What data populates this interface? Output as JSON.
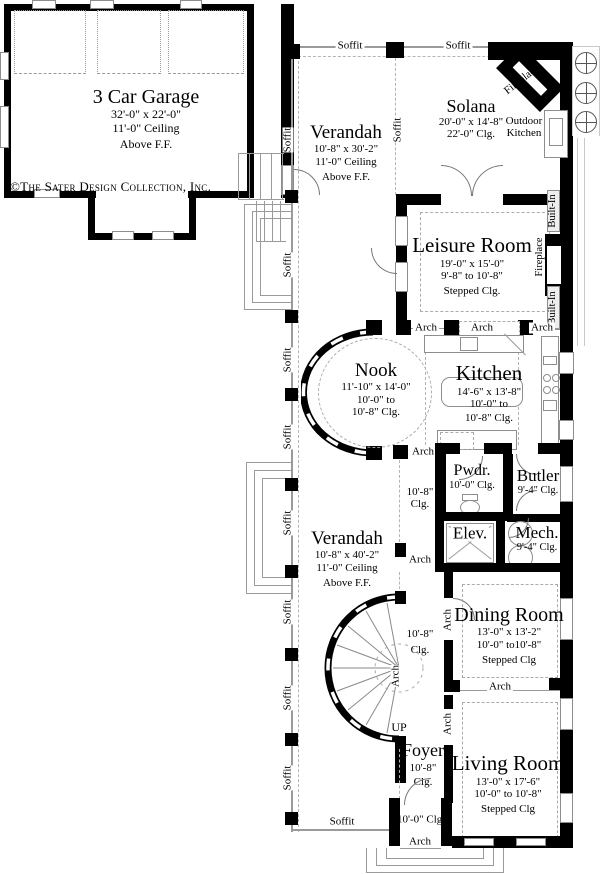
{
  "copyright": "©The Sater Design Collection, Inc.",
  "labels": {
    "soffit": "Soffit",
    "arch": "Arch",
    "up": "UP",
    "built_in": "Built-In",
    "fireplace": "Fireplace",
    "outdoor_line1": "Outdoor",
    "outdoor_line2": "Kitchen"
  },
  "rooms": {
    "garage": {
      "name": "3 Car Garage",
      "dim": "32'-0\" x 22'-0\"",
      "ceiling": "11'-0\" Ceiling",
      "note": "Above F.F."
    },
    "verandah_top": {
      "name": "Verandah",
      "dim": "10'-8\" x 30'-2\"",
      "ceiling": "11'-0\" Ceiling",
      "note": "Above F.F."
    },
    "solana": {
      "name": "Solana",
      "dim": "20'-0\" x 14'-8\"",
      "ceiling": "22'-0\" Clg."
    },
    "leisure": {
      "name": "Leisure Room",
      "dim": "19'-0\" x 15'-0\"",
      "range": "9'-8\" to 10'-8\"",
      "note": "Stepped Clg."
    },
    "nook": {
      "name": "Nook",
      "dim": "11'-10\" x 14'-0\"",
      "range": "10'-0\" to",
      "ceiling": "10'-8\" Clg."
    },
    "kitchen": {
      "name": "Kitchen",
      "dim": "14'-6\" x 13'-8\"",
      "range": "10'-0\" to",
      "ceiling": "10'-8\" Clg."
    },
    "pwdr": {
      "name": "Pwdr.",
      "ceiling": "10'-0\" Clg."
    },
    "butler": {
      "name": "Butler",
      "ceiling": "9'-4\" Clg."
    },
    "hall_upper": {
      "line1": "10'-8\"",
      "line2": "Clg."
    },
    "elev": {
      "name": "Elev."
    },
    "mech": {
      "name": "Mech.",
      "ceiling": "9'-4\" Clg."
    },
    "verandah_bottom": {
      "name": "Verandah",
      "dim": "10'-8\" x 40'-2\"",
      "ceiling": "11'-0\" Ceiling",
      "note": "Above F.F."
    },
    "dining": {
      "name": "Dining Room",
      "dim": "13'-0\" x 13'-2\"",
      "range": "10'-0\" to10'-8\"",
      "note": "Stepped Clg"
    },
    "hall_lower": {
      "line1": "10'-8\"",
      "line2": "Clg."
    },
    "foyer": {
      "name": "Foyer",
      "line1": "10'-8\"",
      "line2": "Clg."
    },
    "living": {
      "name": "Living Room",
      "dim": "13'-0\" x 17'-6\"",
      "range": "10'-0\" to 10'-8\"",
      "note": "Stepped Clg"
    },
    "entry": {
      "ceiling": "10'-0\" Clg."
    }
  }
}
